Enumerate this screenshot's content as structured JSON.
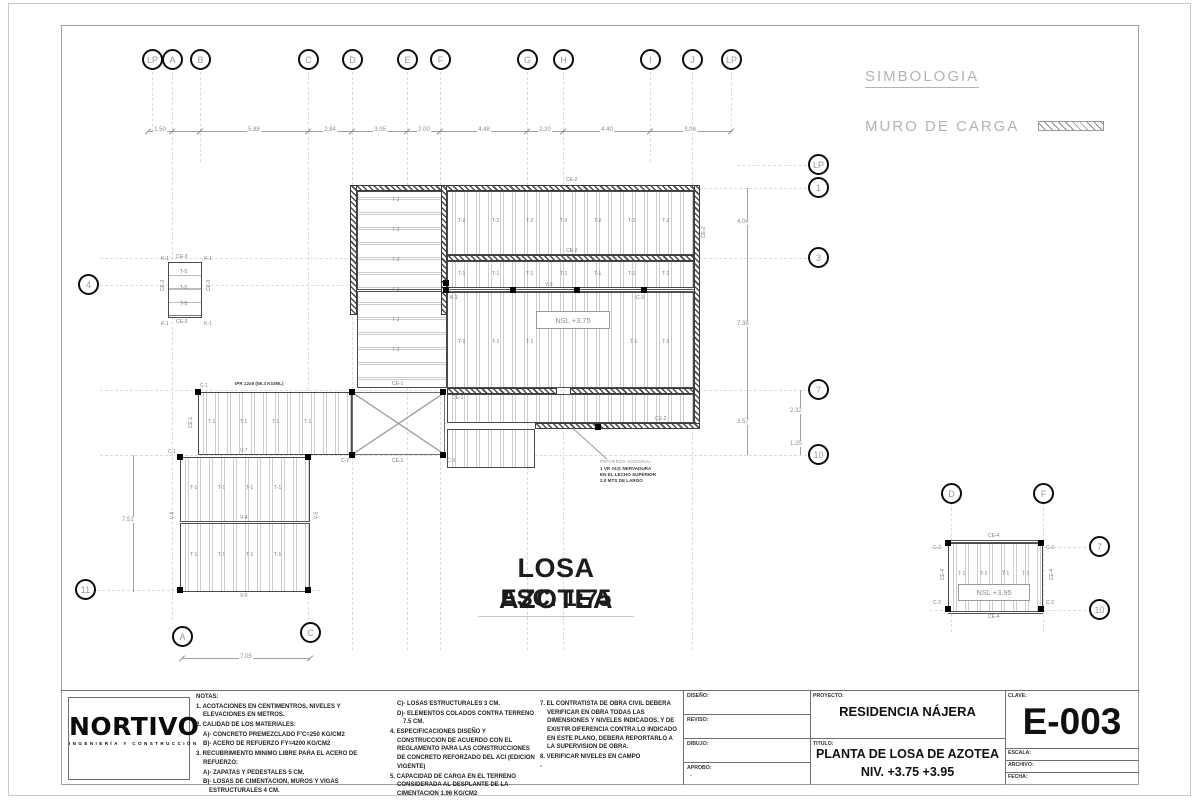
{
  "symbology": {
    "title": "SIMBOLOGIA",
    "item": "MURO DE CARGA"
  },
  "plan": {
    "title": "LOSA AZOTEA",
    "scale": "ESC. 1:75",
    "levels": {
      "main": "NSL +3.75",
      "detail": "NSL +3.95"
    },
    "grid": {
      "top": [
        "LP",
        "A",
        "B",
        "C",
        "D",
        "E",
        "F",
        "G",
        "H",
        "I",
        "J",
        "LP"
      ],
      "right": [
        "LP",
        "1",
        "3",
        "7",
        "10"
      ],
      "left": [
        "4",
        "11"
      ],
      "bottom": [
        "A",
        "C"
      ],
      "detail": [
        "D",
        "F",
        "7",
        "10"
      ]
    },
    "dims": {
      "top": [
        "1.50",
        "5.88",
        "2.84",
        "3.05",
        "2.00",
        "4.48",
        "2.20",
        "4.40",
        "3.08"
      ],
      "right": [
        "4.04",
        "7.38",
        "3.57"
      ],
      "right_outer": [
        "2.32",
        "1.25"
      ],
      "left": "7.51",
      "bottom": "7.05"
    },
    "labels": {
      "ce1": "CE-1",
      "ce2": "CE-2",
      "ce3": "CE-3",
      "ce4": "CE-4",
      "c1": "C-1",
      "c2": "C-2",
      "c3": "C-3",
      "k1": "K-1",
      "v3": "V-3",
      "v4": "V-4",
      "v5": "V-5",
      "v6": "V-6",
      "v7": "V-7",
      "v8": "V-8",
      "t1": "T-1",
      "t2": "T-2",
      "t5": "T-5",
      "ipr": "IPR 12x6 (59.3 KG/ML)"
    },
    "note_leader": [
      "REFUERZO ADICIONAL",
      "1 VR #4@ NERVADURA",
      "EN EL LECHO SUPERIOR",
      "2.0 MTS DE LARGO"
    ]
  },
  "notes": {
    "heading": "NOTAS:",
    "col1": [
      "1. ACOTACIONES EN CENTIMENTROS, NIVELES Y ELEVACIONES EN METROS.",
      "2. CALIDAD DE LOS MATERIALES:",
      "A)- CONCRETO PREMEZCLADO F'C=250 KG/CM2",
      "B)- ACERO DE REFUERZO FY=4200 KG/CM2",
      "3. RECUBRIMIENTO MINIMO LIBRE PARA EL ACERO DE REFUERZO:",
      "A)- ZAPATAS Y PEDESTALES 5 CM.",
      "B)- LOSAS DE CIMENTACION, MUROS Y VIGAS ESTRUCTURALES 4 CM."
    ],
    "col2": [
      "C)- LOSAS ESTRUCTURALES 3 CM.",
      "D)- ELEMENTOS COLADOS CONTRA TERRENO 7.5 CM.",
      "4. ESPECIFICACIONES DISEÑO Y CONSTRUCCION DE ACUERDO CON EL REGLAMENTO PARA LAS CONSTRUCCIONES DE CONCRETO REFORZADO DEL ACI (EDICION VIGENTE)",
      "5. CAPACIDAD DE CARGA EN EL TERRENO CONSIDERADA AL DESPLANTE DE LA CIMENTACION 1.96 KG/CM2",
      "6. EN TODA UNION DE CONCRETO EXISTENTE CON CONCRETO NUEVO USAR ADITIVO SIKADUR-32 PRIMER O SIMILAR"
    ],
    "col3": [
      "7. EL CONTRATISTA DE OBRA CIVIL DEBERA VERIFICAR EN OBRA TODAS LAS DIMENSIONES Y NIVELES INDICADOS, Y DE EXISTIR DIFERENCIA CONTRA LO INDICADO EN ESTE PLANO, DEBERA REPORTARLO A LA SUPERVISION DE OBRA.",
      "8. VERIFICAR NIVELES EN CAMPO",
      "-"
    ]
  },
  "logo": {
    "name": "NORTIVO",
    "tagline": "INGENIERÍA Y CONSTRUCCIÓN"
  },
  "titleblock": {
    "fields": {
      "diseno": "DISEÑO:",
      "reviso": "REVISO:",
      "dibujo": "DIBUJO:",
      "aprobo": "APROBO:",
      "proyecto": "PROYECTO:",
      "titulo": "TITULO:",
      "clave": "CLAVE:",
      "escala": "ESCALA:",
      "archivo": "ARCHIVO:",
      "fecha": "FECHA:"
    },
    "project": "RESIDENCIA NÁJERA",
    "title_line1": "PLANTA DE LOSA DE AZOTEA",
    "title_line2": "NIV. +3.75 +3.95",
    "clave_value": "E-003",
    "aprobo_value": "-"
  },
  "colors": {
    "accent_dark": "#1a1a1a",
    "line_gray": "#8a8a8a",
    "grid_gray": "#d8d8d8",
    "text_gray": "#9a9a9a"
  }
}
